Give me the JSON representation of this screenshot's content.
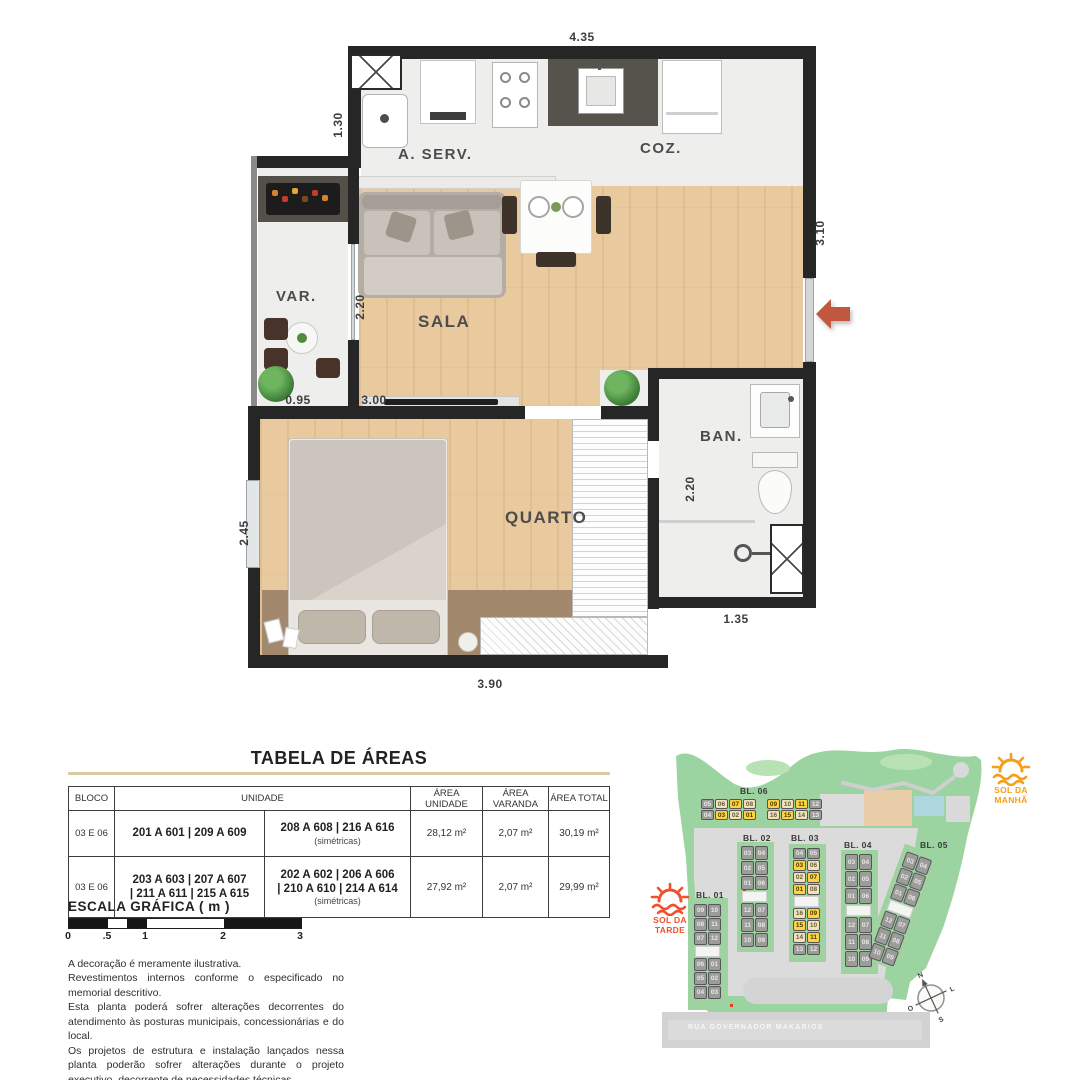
{
  "floor_plan": {
    "room_labels": {
      "aserv": "A. SERV.",
      "coz": "COZ.",
      "var": "VAR.",
      "sala": "SALA",
      "quarto": "QUARTO",
      "ban": "BAN."
    },
    "dimensions": {
      "top": "4.35",
      "aserv_left": "1.30",
      "right": "3.10",
      "sala_left": "2.20",
      "var_bottom": "0.95",
      "sala_bottom": "3.00",
      "quarto_left": "2.45",
      "ban_right": "2.20",
      "ban_bottom": "1.35",
      "quarto_bottom": "3.90"
    },
    "accent_arrow_color": "#c2573f"
  },
  "areas_table": {
    "title": "TABELA DE ÁREAS",
    "headers": {
      "bloco": "BLOCO",
      "unidade": "UNIDADE",
      "area_unidade": "ÁREA UNIDADE",
      "area_varanda": "ÁREA VARANDA",
      "area_total": "ÁREA TOTAL"
    },
    "rows": [
      {
        "bloco": "03 E 06",
        "unidades_a": "201 A 601 | 209 A 609",
        "unidades_b": "208 A 608 | 216 A 616",
        "nota_b": "(simétricas)",
        "area_unidade": "28,12 m²",
        "area_varanda": "2,07 m²",
        "area_total": "30,19 m²"
      },
      {
        "bloco": "03 E 06",
        "unidades_a": "203 A 603 | 207 A 607\n| 211 A 611 | 215 A 615",
        "unidades_b": "202 A 602 | 206 A 606\n| 210 A 610 | 214 A 614",
        "nota_b": "(simétricas)",
        "area_unidade": "27,92 m²",
        "area_varanda": "2,07 m²",
        "area_total": "29,99 m²"
      }
    ]
  },
  "scale_bar": {
    "title": "ESCALA GRÁFICA ( m )",
    "ticks": [
      "0",
      ".5",
      "1",
      "2",
      "3"
    ]
  },
  "disclaimer": {
    "lines": [
      "A decoração é meramente ilustrativa.",
      "Revestimentos internos conforme o especificado no memorial descritivo.",
      "Esta planta poderá sofrer alterações decorrentes do atendimento às posturas municipais, concessionárias e do local.",
      "Os projetos de estrutura e instalação lançados nessa planta poderão sofrer alterações durante o projeto executivo, decorrente de necessidades técnicas.",
      "As cotas são medidas de eixo a eixo de parede, podendo sofrer variação de até 5% durante a obra"
    ]
  },
  "site_plan": {
    "sun_morning": {
      "line1": "SOL DA",
      "line2": "MANHÃ",
      "color": "#f59e19"
    },
    "sun_afternoon": {
      "line1": "SOL DA",
      "line2": "TARDE",
      "color": "#f1502b"
    },
    "street_name": "RUA GOVERNADOR MAKARIOS",
    "compass": {
      "n": "N",
      "l": "L",
      "s": "S",
      "o": "O"
    },
    "legend_colors": {
      "highlight": "#ffd23e",
      "symmetric": "#f0e2be",
      "other": "#9c9c9a"
    },
    "blocks": [
      {
        "id": "bl06",
        "label": "BL. 06",
        "orientation": "horizontal",
        "rows": [
          [
            {
              "n": "05",
              "c": "g"
            },
            {
              "n": "06",
              "c": "b"
            },
            {
              "n": "07",
              "c": "y"
            },
            {
              "n": "08",
              "c": "b"
            },
            {
              "gap": true
            },
            {
              "n": "09",
              "c": "y"
            },
            {
              "n": "10",
              "c": "b"
            },
            {
              "n": "11",
              "c": "y"
            },
            {
              "n": "12",
              "c": "g"
            }
          ],
          [
            {
              "n": "04",
              "c": "g"
            },
            {
              "n": "03",
              "c": "y"
            },
            {
              "n": "02",
              "c": "b"
            },
            {
              "n": "01",
              "c": "y"
            },
            {
              "gap": true
            },
            {
              "n": "16",
              "c": "b"
            },
            {
              "n": "15",
              "c": "y"
            },
            {
              "n": "14",
              "c": "b"
            },
            {
              "n": "13",
              "c": "g"
            }
          ]
        ]
      },
      {
        "id": "bl01",
        "label": "BL. 01",
        "orientation": "vertical",
        "rows": [
          [
            {
              "n": "09",
              "c": "g"
            },
            {
              "n": "10",
              "c": "g"
            }
          ],
          [
            {
              "n": "08",
              "c": "g"
            },
            {
              "n": "11",
              "c": "g"
            }
          ],
          [
            {
              "n": "07",
              "c": "g"
            },
            {
              "n": "12",
              "c": "g"
            }
          ],
          [
            {
              "gap": true
            }
          ],
          [
            {
              "n": "06",
              "c": "g"
            },
            {
              "n": "01",
              "c": "g"
            }
          ],
          [
            {
              "n": "05",
              "c": "g"
            },
            {
              "n": "02",
              "c": "g"
            }
          ],
          [
            {
              "n": "04",
              "c": "g"
            },
            {
              "n": "03",
              "c": "g"
            }
          ]
        ]
      },
      {
        "id": "bl02",
        "label": "BL. 02",
        "orientation": "vertical",
        "rows": [
          [
            {
              "n": "03",
              "c": "g"
            },
            {
              "n": "04",
              "c": "g"
            }
          ],
          [
            {
              "n": "02",
              "c": "g"
            },
            {
              "n": "05",
              "c": "g"
            }
          ],
          [
            {
              "n": "01",
              "c": "g"
            },
            {
              "n": "06",
              "c": "g"
            }
          ],
          [
            {
              "gap": true
            }
          ],
          [
            {
              "n": "12",
              "c": "g"
            },
            {
              "n": "07",
              "c": "g"
            }
          ],
          [
            {
              "n": "11",
              "c": "g"
            },
            {
              "n": "08",
              "c": "g"
            }
          ],
          [
            {
              "n": "10",
              "c": "g"
            },
            {
              "n": "09",
              "c": "g"
            }
          ]
        ]
      },
      {
        "id": "bl03",
        "label": "BL. 03",
        "orientation": "vertical",
        "rows": [
          [
            {
              "n": "04",
              "c": "g"
            },
            {
              "n": "05",
              "c": "g"
            }
          ],
          [
            {
              "n": "03",
              "c": "y"
            },
            {
              "n": "06",
              "c": "b"
            }
          ],
          [
            {
              "n": "02",
              "c": "b"
            },
            {
              "n": "07",
              "c": "y"
            }
          ],
          [
            {
              "n": "01",
              "c": "y"
            },
            {
              "n": "08",
              "c": "b"
            }
          ],
          [
            {
              "gap": true
            }
          ],
          [
            {
              "n": "16",
              "c": "b"
            },
            {
              "n": "09",
              "c": "y"
            }
          ],
          [
            {
              "n": "15",
              "c": "y"
            },
            {
              "n": "10",
              "c": "b"
            }
          ],
          [
            {
              "n": "14",
              "c": "b"
            },
            {
              "n": "11",
              "c": "y"
            }
          ],
          [
            {
              "n": "13",
              "c": "g"
            },
            {
              "n": "12",
              "c": "g"
            }
          ]
        ]
      },
      {
        "id": "bl04",
        "label": "BL. 04",
        "orientation": "vertical",
        "rows": [
          [
            {
              "n": "03",
              "c": "g"
            },
            {
              "n": "04",
              "c": "g"
            }
          ],
          [
            {
              "n": "02",
              "c": "g"
            },
            {
              "n": "05",
              "c": "g"
            }
          ],
          [
            {
              "n": "01",
              "c": "g"
            },
            {
              "n": "06",
              "c": "g"
            }
          ],
          [
            {
              "gap": true
            }
          ],
          [
            {
              "n": "12",
              "c": "g"
            },
            {
              "n": "07",
              "c": "g"
            }
          ],
          [
            {
              "n": "11",
              "c": "g"
            },
            {
              "n": "08",
              "c": "g"
            }
          ],
          [
            {
              "n": "10",
              "c": "g"
            },
            {
              "n": "09",
              "c": "g"
            }
          ]
        ]
      },
      {
        "id": "bl05",
        "label": "BL. 05",
        "orientation": "vertical-rotated",
        "rows": [
          [
            {
              "n": "03",
              "c": "g"
            },
            {
              "n": "04",
              "c": "g"
            }
          ],
          [
            {
              "n": "02",
              "c": "g"
            },
            {
              "n": "05",
              "c": "g"
            }
          ],
          [
            {
              "n": "01",
              "c": "g"
            },
            {
              "n": "06",
              "c": "g"
            }
          ],
          [
            {
              "gap": true
            }
          ],
          [
            {
              "n": "12",
              "c": "g"
            },
            {
              "n": "07",
              "c": "g"
            }
          ],
          [
            {
              "n": "11",
              "c": "g"
            },
            {
              "n": "08",
              "c": "g"
            }
          ],
          [
            {
              "n": "10",
              "c": "g"
            },
            {
              "n": "09",
              "c": "g"
            }
          ]
        ]
      }
    ]
  }
}
